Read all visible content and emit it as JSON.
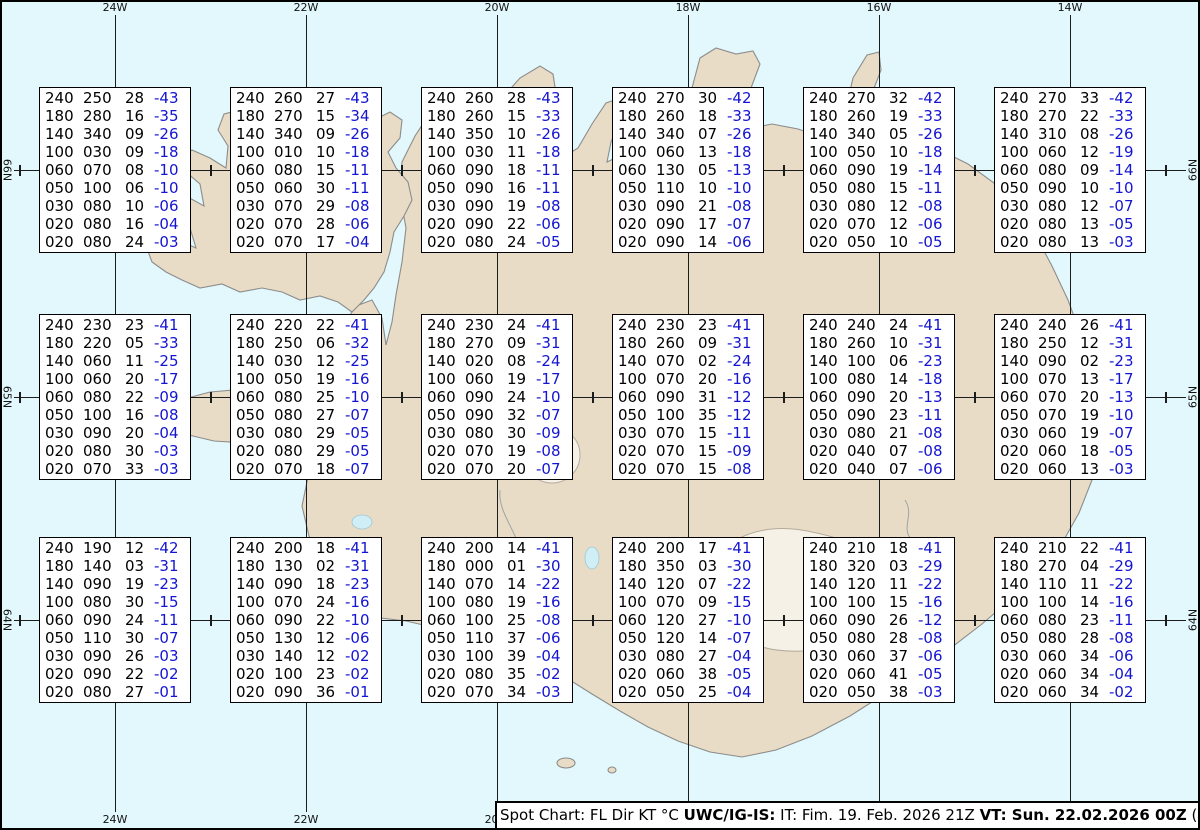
{
  "colors": {
    "sea": "#e2f8fc",
    "land": "#e9dcc6",
    "glacier": "#f6f1e6",
    "coast": "#8c8c8c",
    "lake": "#cfeef5",
    "grid": "#1c1c1c",
    "box_bg": "#ffffff",
    "box_border": "#000000",
    "temp": "#1414d2"
  },
  "graticule": {
    "meridians": [
      {
        "label": "24W",
        "x": 115
      },
      {
        "label": "22W",
        "x": 306
      },
      {
        "label": "20W",
        "x": 497
      },
      {
        "label": "18W",
        "x": 688
      },
      {
        "label": "16W",
        "x": 879
      },
      {
        "label": "14W",
        "x": 1070
      }
    ],
    "parallels": [
      {
        "label": "66N",
        "y": 170
      },
      {
        "label": "65N",
        "y": 397
      },
      {
        "label": "64N",
        "y": 620
      }
    ],
    "minor_meridians_x": [
      19.5,
      210.5,
      401.5,
      592.5,
      783.5,
      974.5,
      1165.5
    ]
  },
  "status_bar": {
    "segments": [
      {
        "text": "Spot Chart: FL Dir KT °C ",
        "bold": false
      },
      {
        "text": "UWC/IG-IS:",
        "bold": true
      },
      {
        "text": " IT: Fim. 19. Feb. 2026 21Z ",
        "bold": false
      },
      {
        "text": "VT: Sun. 22.02.2026 00Z",
        "bold": true
      },
      {
        "text": " (+51 h)",
        "bold": false
      }
    ]
  },
  "spot_columns": [
    "FL",
    "Dir",
    "KT",
    "°C"
  ],
  "spot_boxes": [
    {
      "lon": "24W",
      "lat": "66N",
      "cx": 115,
      "cy": 170,
      "rows": [
        [
          "240",
          "250",
          "28",
          "-43"
        ],
        [
          "180",
          "280",
          "16",
          "-35"
        ],
        [
          "140",
          "340",
          "09",
          "-26"
        ],
        [
          "100",
          "030",
          "09",
          "-18"
        ],
        [
          "060",
          "070",
          "08",
          "-10"
        ],
        [
          "050",
          "100",
          "06",
          "-10"
        ],
        [
          "030",
          "080",
          "10",
          "-06"
        ],
        [
          "020",
          "080",
          "16",
          "-04"
        ],
        [
          "020",
          "080",
          "24",
          "-03"
        ]
      ]
    },
    {
      "lon": "22W",
      "lat": "66N",
      "cx": 306,
      "cy": 170,
      "rows": [
        [
          "240",
          "260",
          "27",
          "-43"
        ],
        [
          "180",
          "270",
          "15",
          "-34"
        ],
        [
          "140",
          "340",
          "09",
          "-26"
        ],
        [
          "100",
          "010",
          "10",
          "-18"
        ],
        [
          "060",
          "080",
          "15",
          "-11"
        ],
        [
          "050",
          "060",
          "30",
          "-11"
        ],
        [
          "030",
          "070",
          "29",
          "-08"
        ],
        [
          "020",
          "070",
          "28",
          "-06"
        ],
        [
          "020",
          "070",
          "17",
          "-04"
        ]
      ]
    },
    {
      "lon": "20W",
      "lat": "66N",
      "cx": 497,
      "cy": 170,
      "rows": [
        [
          "240",
          "260",
          "28",
          "-43"
        ],
        [
          "180",
          "260",
          "15",
          "-33"
        ],
        [
          "140",
          "350",
          "10",
          "-26"
        ],
        [
          "100",
          "030",
          "11",
          "-18"
        ],
        [
          "060",
          "090",
          "18",
          "-11"
        ],
        [
          "050",
          "090",
          "16",
          "-11"
        ],
        [
          "030",
          "090",
          "19",
          "-08"
        ],
        [
          "020",
          "090",
          "22",
          "-06"
        ],
        [
          "020",
          "080",
          "24",
          "-05"
        ]
      ]
    },
    {
      "lon": "18W",
      "lat": "66N",
      "cx": 688,
      "cy": 170,
      "rows": [
        [
          "240",
          "270",
          "30",
          "-42"
        ],
        [
          "180",
          "260",
          "18",
          "-33"
        ],
        [
          "140",
          "340",
          "07",
          "-26"
        ],
        [
          "100",
          "060",
          "13",
          "-18"
        ],
        [
          "060",
          "130",
          "05",
          "-13"
        ],
        [
          "050",
          "110",
          "10",
          "-10"
        ],
        [
          "030",
          "090",
          "21",
          "-08"
        ],
        [
          "020",
          "090",
          "17",
          "-07"
        ],
        [
          "020",
          "090",
          "14",
          "-06"
        ]
      ]
    },
    {
      "lon": "16W",
      "lat": "66N",
      "cx": 879,
      "cy": 170,
      "rows": [
        [
          "240",
          "270",
          "32",
          "-42"
        ],
        [
          "180",
          "260",
          "19",
          "-33"
        ],
        [
          "140",
          "340",
          "05",
          "-26"
        ],
        [
          "100",
          "050",
          "10",
          "-18"
        ],
        [
          "060",
          "090",
          "19",
          "-14"
        ],
        [
          "050",
          "080",
          "15",
          "-11"
        ],
        [
          "030",
          "080",
          "12",
          "-08"
        ],
        [
          "020",
          "070",
          "12",
          "-06"
        ],
        [
          "020",
          "050",
          "10",
          "-05"
        ]
      ]
    },
    {
      "lon": "14W",
      "lat": "66N",
      "cx": 1070,
      "cy": 170,
      "rows": [
        [
          "240",
          "270",
          "33",
          "-42"
        ],
        [
          "180",
          "270",
          "22",
          "-33"
        ],
        [
          "140",
          "310",
          "08",
          "-26"
        ],
        [
          "100",
          "060",
          "12",
          "-19"
        ],
        [
          "060",
          "080",
          "09",
          "-14"
        ],
        [
          "050",
          "090",
          "10",
          "-10"
        ],
        [
          "030",
          "080",
          "12",
          "-07"
        ],
        [
          "020",
          "080",
          "13",
          "-05"
        ],
        [
          "020",
          "080",
          "13",
          "-03"
        ]
      ]
    },
    {
      "lon": "24W",
      "lat": "65N",
      "cx": 115,
      "cy": 397,
      "rows": [
        [
          "240",
          "230",
          "23",
          "-41"
        ],
        [
          "180",
          "220",
          "05",
          "-33"
        ],
        [
          "140",
          "060",
          "11",
          "-25"
        ],
        [
          "100",
          "060",
          "20",
          "-17"
        ],
        [
          "060",
          "080",
          "22",
          "-09"
        ],
        [
          "050",
          "100",
          "16",
          "-08"
        ],
        [
          "030",
          "090",
          "20",
          "-04"
        ],
        [
          "020",
          "080",
          "30",
          "-03"
        ],
        [
          "020",
          "070",
          "33",
          "-03"
        ]
      ]
    },
    {
      "lon": "22W",
      "lat": "65N",
      "cx": 306,
      "cy": 397,
      "rows": [
        [
          "240",
          "220",
          "22",
          "-41"
        ],
        [
          "180",
          "250",
          "06",
          "-32"
        ],
        [
          "140",
          "030",
          "12",
          "-25"
        ],
        [
          "100",
          "050",
          "19",
          "-16"
        ],
        [
          "060",
          "080",
          "25",
          "-10"
        ],
        [
          "050",
          "080",
          "27",
          "-07"
        ],
        [
          "030",
          "080",
          "29",
          "-05"
        ],
        [
          "020",
          "080",
          "29",
          "-05"
        ],
        [
          "020",
          "070",
          "18",
          "-07"
        ]
      ]
    },
    {
      "lon": "20W",
      "lat": "65N",
      "cx": 497,
      "cy": 397,
      "rows": [
        [
          "240",
          "230",
          "24",
          "-41"
        ],
        [
          "180",
          "270",
          "09",
          "-31"
        ],
        [
          "140",
          "020",
          "08",
          "-24"
        ],
        [
          "100",
          "060",
          "19",
          "-17"
        ],
        [
          "060",
          "090",
          "24",
          "-10"
        ],
        [
          "050",
          "090",
          "32",
          "-07"
        ],
        [
          "030",
          "080",
          "30",
          "-09"
        ],
        [
          "020",
          "070",
          "19",
          "-08"
        ],
        [
          "020",
          "070",
          "20",
          "-07"
        ]
      ]
    },
    {
      "lon": "18W",
      "lat": "65N",
      "cx": 688,
      "cy": 397,
      "rows": [
        [
          "240",
          "230",
          "23",
          "-41"
        ],
        [
          "180",
          "260",
          "09",
          "-31"
        ],
        [
          "140",
          "070",
          "02",
          "-24"
        ],
        [
          "100",
          "070",
          "20",
          "-16"
        ],
        [
          "060",
          "090",
          "31",
          "-12"
        ],
        [
          "050",
          "100",
          "35",
          "-12"
        ],
        [
          "030",
          "070",
          "15",
          "-11"
        ],
        [
          "020",
          "070",
          "15",
          "-09"
        ],
        [
          "020",
          "070",
          "15",
          "-08"
        ]
      ]
    },
    {
      "lon": "16W",
      "lat": "65N",
      "cx": 879,
      "cy": 397,
      "rows": [
        [
          "240",
          "240",
          "24",
          "-41"
        ],
        [
          "180",
          "260",
          "10",
          "-31"
        ],
        [
          "140",
          "100",
          "06",
          "-23"
        ],
        [
          "100",
          "080",
          "14",
          "-18"
        ],
        [
          "060",
          "090",
          "20",
          "-13"
        ],
        [
          "050",
          "090",
          "23",
          "-11"
        ],
        [
          "030",
          "080",
          "21",
          "-08"
        ],
        [
          "020",
          "040",
          "07",
          "-08"
        ],
        [
          "020",
          "040",
          "07",
          "-06"
        ]
      ]
    },
    {
      "lon": "14W",
      "lat": "65N",
      "cx": 1070,
      "cy": 397,
      "rows": [
        [
          "240",
          "240",
          "26",
          "-41"
        ],
        [
          "180",
          "250",
          "12",
          "-31"
        ],
        [
          "140",
          "090",
          "02",
          "-23"
        ],
        [
          "100",
          "070",
          "13",
          "-17"
        ],
        [
          "060",
          "070",
          "20",
          "-13"
        ],
        [
          "050",
          "070",
          "19",
          "-10"
        ],
        [
          "030",
          "060",
          "19",
          "-07"
        ],
        [
          "020",
          "060",
          "18",
          "-05"
        ],
        [
          "020",
          "060",
          "13",
          "-03"
        ]
      ]
    },
    {
      "lon": "24W",
      "lat": "64N",
      "cx": 115,
      "cy": 620,
      "rows": [
        [
          "240",
          "190",
          "12",
          "-42"
        ],
        [
          "180",
          "140",
          "03",
          "-31"
        ],
        [
          "140",
          "090",
          "19",
          "-23"
        ],
        [
          "100",
          "080",
          "30",
          "-15"
        ],
        [
          "060",
          "090",
          "24",
          "-11"
        ],
        [
          "050",
          "110",
          "30",
          "-07"
        ],
        [
          "030",
          "090",
          "26",
          "-03"
        ],
        [
          "020",
          "090",
          "22",
          "-02"
        ],
        [
          "020",
          "080",
          "27",
          "-01"
        ]
      ]
    },
    {
      "lon": "22W",
      "lat": "64N",
      "cx": 306,
      "cy": 620,
      "rows": [
        [
          "240",
          "200",
          "18",
          "-41"
        ],
        [
          "180",
          "130",
          "02",
          "-31"
        ],
        [
          "140",
          "090",
          "18",
          "-23"
        ],
        [
          "100",
          "070",
          "24",
          "-16"
        ],
        [
          "060",
          "090",
          "22",
          "-10"
        ],
        [
          "050",
          "130",
          "12",
          "-06"
        ],
        [
          "030",
          "140",
          "12",
          "-02"
        ],
        [
          "020",
          "100",
          "23",
          "-02"
        ],
        [
          "020",
          "090",
          "36",
          "-01"
        ]
      ]
    },
    {
      "lon": "20W",
      "lat": "64N",
      "cx": 497,
      "cy": 620,
      "rows": [
        [
          "240",
          "200",
          "14",
          "-41"
        ],
        [
          "180",
          "000",
          "01",
          "-30"
        ],
        [
          "140",
          "070",
          "14",
          "-22"
        ],
        [
          "100",
          "080",
          "19",
          "-16"
        ],
        [
          "060",
          "100",
          "25",
          "-08"
        ],
        [
          "050",
          "110",
          "37",
          "-06"
        ],
        [
          "030",
          "100",
          "39",
          "-04"
        ],
        [
          "020",
          "080",
          "35",
          "-02"
        ],
        [
          "020",
          "070",
          "34",
          "-03"
        ]
      ]
    },
    {
      "lon": "18W",
      "lat": "64N",
      "cx": 688,
      "cy": 620,
      "rows": [
        [
          "240",
          "200",
          "17",
          "-41"
        ],
        [
          "180",
          "350",
          "03",
          "-30"
        ],
        [
          "140",
          "120",
          "07",
          "-22"
        ],
        [
          "100",
          "070",
          "09",
          "-15"
        ],
        [
          "060",
          "120",
          "27",
          "-10"
        ],
        [
          "050",
          "120",
          "14",
          "-07"
        ],
        [
          "030",
          "080",
          "27",
          "-04"
        ],
        [
          "020",
          "060",
          "38",
          "-05"
        ],
        [
          "020",
          "050",
          "25",
          "-04"
        ]
      ]
    },
    {
      "lon": "16W",
      "lat": "64N",
      "cx": 879,
      "cy": 620,
      "rows": [
        [
          "240",
          "210",
          "18",
          "-41"
        ],
        [
          "180",
          "320",
          "03",
          "-29"
        ],
        [
          "140",
          "120",
          "11",
          "-22"
        ],
        [
          "100",
          "100",
          "15",
          "-16"
        ],
        [
          "060",
          "090",
          "26",
          "-12"
        ],
        [
          "050",
          "080",
          "28",
          "-08"
        ],
        [
          "030",
          "060",
          "37",
          "-06"
        ],
        [
          "020",
          "060",
          "41",
          "-05"
        ],
        [
          "020",
          "050",
          "38",
          "-03"
        ]
      ]
    },
    {
      "lon": "14W",
      "lat": "64N",
      "cx": 1070,
      "cy": 620,
      "rows": [
        [
          "240",
          "210",
          "22",
          "-41"
        ],
        [
          "180",
          "270",
          "04",
          "-29"
        ],
        [
          "140",
          "110",
          "11",
          "-22"
        ],
        [
          "100",
          "100",
          "14",
          "-16"
        ],
        [
          "060",
          "080",
          "23",
          "-11"
        ],
        [
          "050",
          "080",
          "28",
          "-08"
        ],
        [
          "030",
          "060",
          "34",
          "-06"
        ],
        [
          "020",
          "060",
          "34",
          "-04"
        ],
        [
          "020",
          "060",
          "34",
          "-02"
        ]
      ]
    }
  ]
}
